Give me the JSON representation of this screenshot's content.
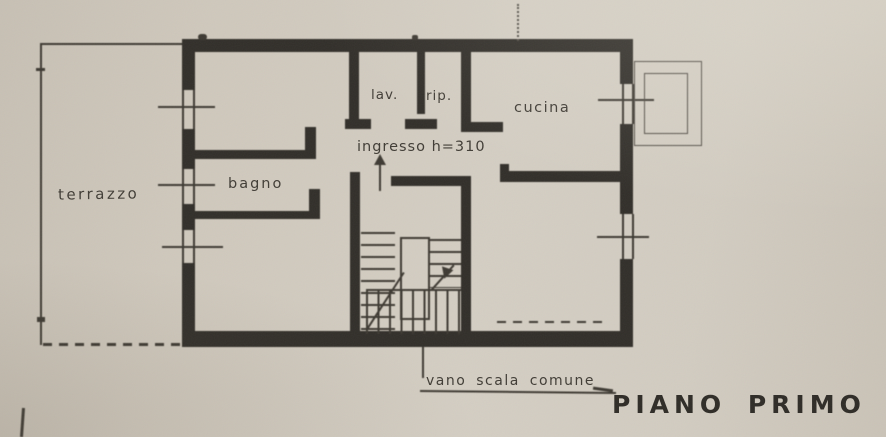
{
  "plan": {
    "floor_title": "PIANO PRIMO",
    "stair_caption": "vano scala comune",
    "labels": {
      "terrazzo": "terrazzo",
      "bagno": "bagno",
      "lav": "lav.",
      "rip": "rip.",
      "cucina": "cucina",
      "ingresso": "ingresso h=310"
    },
    "colors": {
      "paper": "#cfc8bc",
      "ink": "#34312c",
      "ink_thin": "#403c35",
      "ink_faint": "#55504a"
    }
  }
}
